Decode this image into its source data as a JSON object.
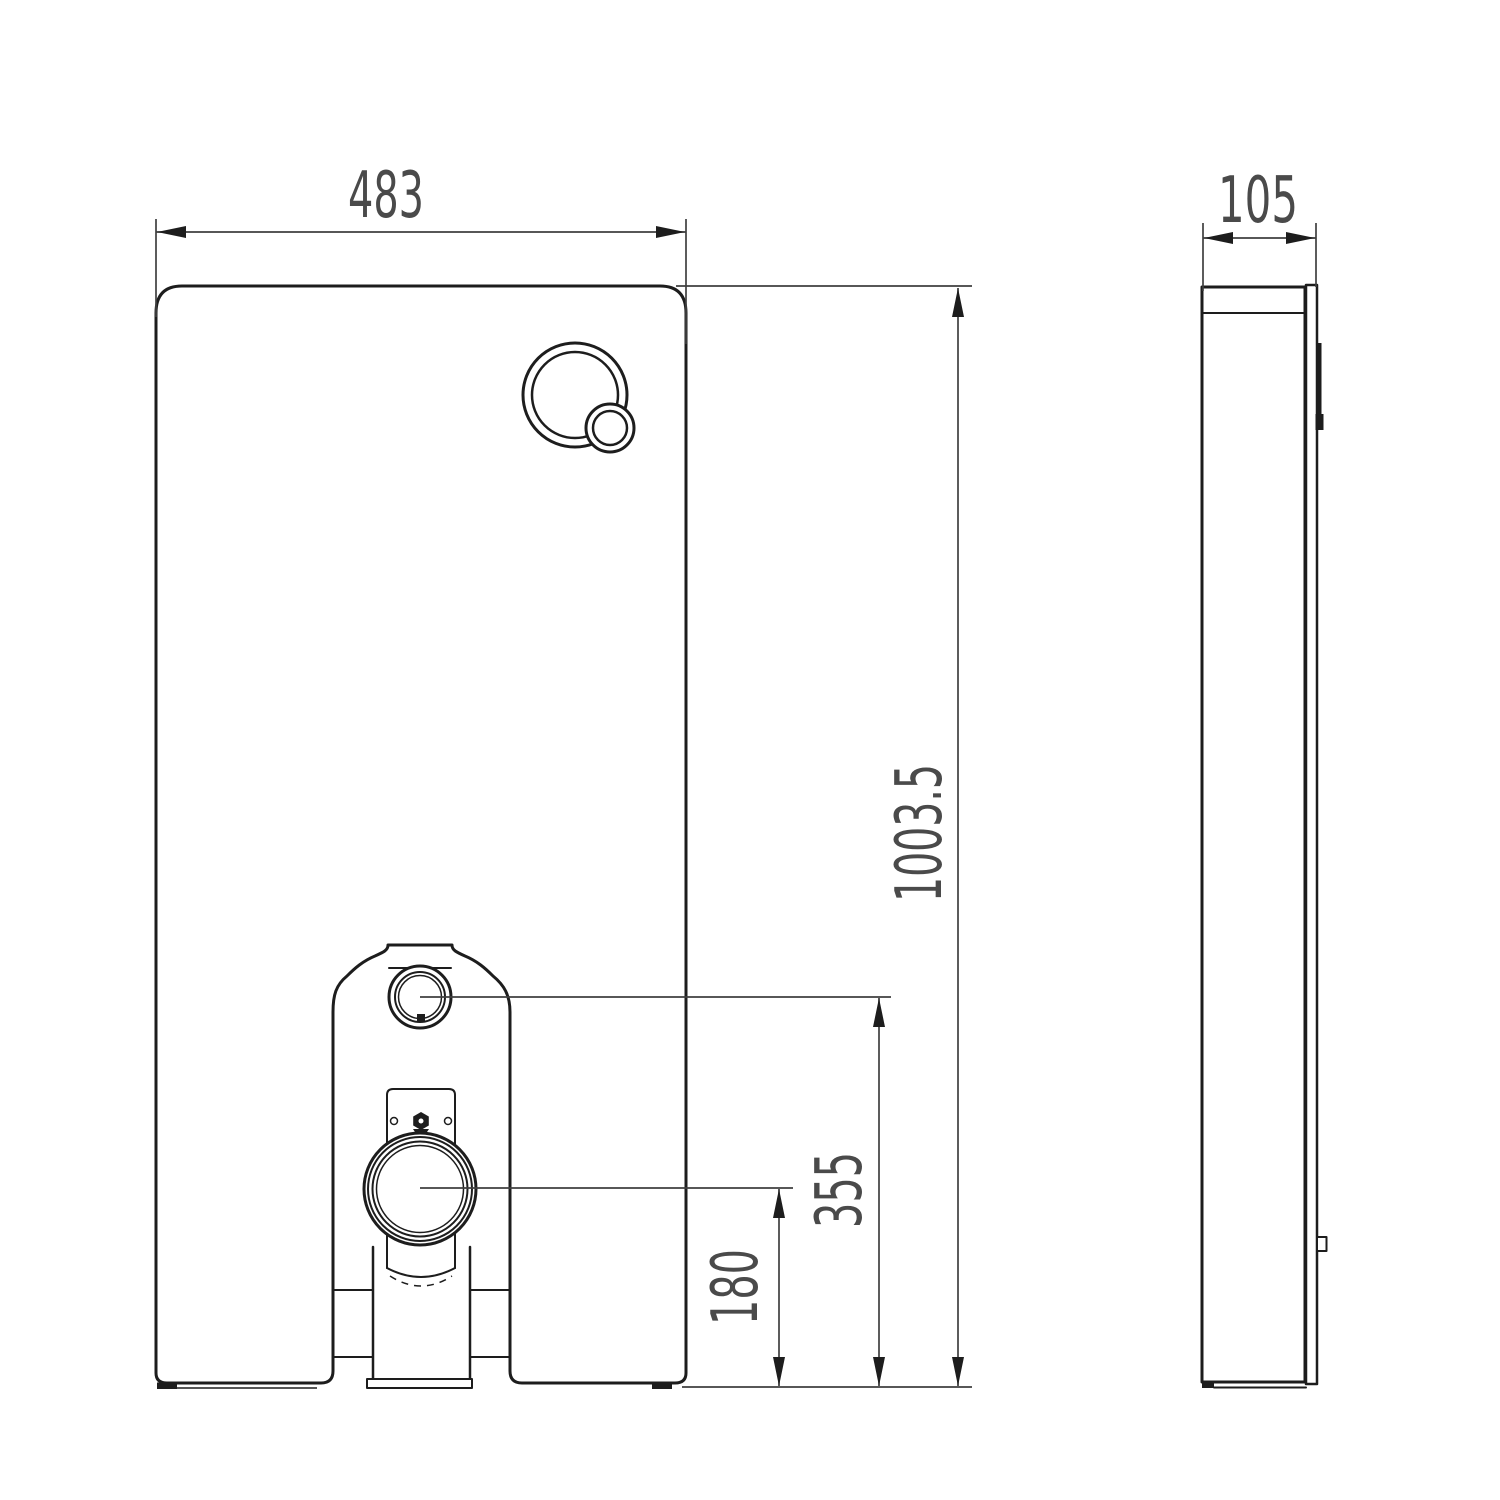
{
  "page": {
    "background": "#ffffff"
  },
  "drawing": {
    "kind": "technical-drawing",
    "colors": {
      "object_line": "#1d1d1d",
      "dimension_line": "#3f3f3f",
      "text": "#4a4a4a",
      "background": "#ffffff"
    },
    "views": {
      "front": {
        "name": "front view"
      },
      "side": {
        "name": "side view"
      }
    },
    "dimensions": {
      "front_width": "483",
      "side_depth": "105",
      "overall_height": "1003.5",
      "inlet_center_height": "355",
      "outlet_center_height": "180"
    }
  }
}
